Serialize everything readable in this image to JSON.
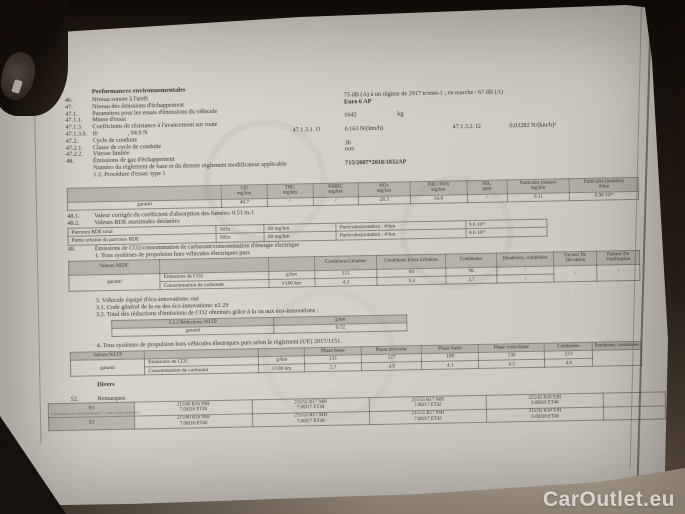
{
  "watermark": "CarOutlet.eu",
  "heading": "Performances environnementales",
  "bottom": {
    "divers": "Divers",
    "rem_num": "52.",
    "remarques": "Remarques",
    "tyres_note": "Combinaisons pneumatiques / roues homologuées :"
  },
  "top_lines": [
    {
      "n": "46.",
      "l": "Niveau sonore à l'arrêt",
      "v": "75 dB (A)    à un régime de 2917 tr/min-1 ; en marche :   67 dB (A)"
    },
    {
      "n": "47.",
      "l": "Niveau des émissions d'échappement",
      "v": "Euro 6 AP",
      "vb": true
    },
    {
      "n": "47.1.",
      "l": "Paramètres pour les essais d'émissions du véhicule"
    },
    {
      "n": "47.1.1.",
      "l": "Masse d'essai",
      "v": "1642",
      "v2": "kg"
    },
    {
      "n": "47.1.3.",
      "l": "Coefficients de résistance à l'avancement sur route"
    },
    {
      "n": "47.1.3.0.",
      "l": "f0",
      "ex": [
        {
          "t": ",  94.9 N",
          "x": 62
        },
        {
          "t": "47.1.3.1.  f1",
          "x": 227
        },
        {
          "t": "0.163 N/(km/h)",
          "x": 279
        },
        {
          "t": "47.1.3.2.  f2",
          "x": 387
        },
        {
          "t": "0.03282 N/(km/h)²",
          "x": 444
        }
      ]
    },
    {
      "n": "47.2.",
      "l": "Cycle de conduite"
    },
    {
      "n": "47.2.1.",
      "l": "Classe de cycle de conduite",
      "v": "3b"
    },
    {
      "n": "47.2.2.",
      "l": "Vitesse limitée",
      "v": "non"
    },
    {
      "n": "48.",
      "l": "Émissions de gaz d'échappement"
    },
    {
      "n": "",
      "l": "Numéro du règlement de base et du dernier règlement modificateur applicable",
      "v": "715/2007*2018/1832AP",
      "vb": true
    },
    {
      "n": "",
      "l": "1.2. Procédure d'essai: type 1"
    }
  ],
  "mid_lines": [
    {
      "n": "48.1.",
      "l": "Valeur corrigée du coefficient d'absorption des fumées: 0.51 m-1"
    },
    {
      "n": "48.2.",
      "l": "Valeurs RDE maximales déclarées"
    }
  ],
  "co2_lines": [
    {
      "n": "49.",
      "l": "Émissions de CO2/consommation de carburant/consommation d'énergie électrique"
    },
    {
      "n": "",
      "l": "1. Tous systèmes de propulsion hors véhicules électriques purs"
    }
  ],
  "eco_lines": [
    {
      "n": "",
      "l": "3. Véhicule équipé d'éco-innovations: oui"
    },
    {
      "n": "",
      "l": "3.1. Code général de la ou des éco-innovations: e2 29"
    },
    {
      "n": "",
      "l": "3.2. Total des réductions d'émissions de CO2 obtenues grâce à la ou aux éco-innovations :"
    }
  ],
  "wltp_lines": [
    {
      "n": "",
      "l": "4. Tous systèmes de propulsion hors véhicules électriques purs selon le règlement (UE) 2017/1151."
    }
  ],
  "tables": {
    "type1": {
      "left": 0,
      "top": 175,
      "width": 572,
      "colw": [
        27,
        8,
        8,
        8,
        9,
        10,
        7,
        11,
        12
      ],
      "header": [
        {
          "t": ""
        },
        {
          "t": "CO",
          "u": "mg/km"
        },
        {
          "t": "THC",
          "u": "mg/km"
        },
        {
          "t": "NMHC",
          "u": "mg/km"
        },
        {
          "t": "NOx",
          "u": "mg/km"
        },
        {
          "t": "THC+NOx",
          "u": "mg/km"
        },
        {
          "t": "NH₃",
          "u": "ppm"
        },
        {
          "t": "Particules (masse)",
          "u": "mg/km"
        },
        {
          "t": "Particules (nombre)",
          "u": "#/km"
        }
      ],
      "rows": [
        [
          "garanti",
          "46.7",
          "/",
          "/",
          "28.3",
          "34.8",
          "/",
          "0.11",
          "0.98 10¹¹"
        ]
      ]
    },
    "rde": {
      "left": 0,
      "top": 215,
      "width": 480,
      "colw": [
        31,
        10,
        15,
        27,
        17
      ],
      "rows": [
        [
          "Parcours RDE total",
          "NOx",
          "60 mg/km",
          "Particules(nombre) : #/km",
          "9.6 10¹¹"
        ],
        [
          "Partie urbaine du parcours RDE",
          "NOx",
          "60 mg/km",
          "Particules(nombre) : #/km",
          "6.6 10¹¹"
        ]
      ]
    },
    "nedc": {
      "left": 0,
      "top": 248,
      "width": 572,
      "colw": [
        16,
        19,
        8,
        11,
        12,
        9,
        10,
        7.5,
        7.5
      ],
      "header": [
        {
          "t": "Valeurs NEDC"
        },
        {
          "t": ""
        },
        {
          "t": ""
        },
        {
          "t": "Conditions Urbaines"
        },
        {
          "t": "Conditions Extra Urbaines"
        },
        {
          "t": "Combinées"
        },
        {
          "t": "Pondérées, combinées"
        },
        {
          "t": "Facteur De Déviation"
        },
        {
          "t": "Facteur De Vérification"
        }
      ],
      "rows": [
        [
          {
            "t": "garanti",
            "rs": 2
          },
          {
            "t": "Émissions de CO2",
            "cls": "lbl"
          },
          "g/km",
          "111",
          "90",
          "96",
          "/",
          {
            "t": "/",
            "rs": 2
          },
          {
            "t": "/",
            "rs": 2
          }
        ],
        [
          null,
          {
            "t": "Consommation de carburant",
            "cls": "lbl"
          },
          "l/100 km",
          "4.2",
          "3.4",
          "3.7",
          "/",
          null,
          null
        ]
      ]
    },
    "eco": {
      "left": 42,
      "top": 308,
      "width": 296,
      "colw": [
        55,
        45
      ],
      "header": [
        {
          "t": "3.2.2 Réductions WLTP"
        },
        {
          "t": "g/km"
        }
      ],
      "rows": [
        [
          "garanti",
          "0.72"
        ]
      ]
    },
    "wltp": {
      "left": 0,
      "top": 339,
      "width": 572,
      "colw": [
        13,
        20,
        8,
        10,
        10.5,
        10,
        11.5,
        8.5,
        8.5
      ],
      "header": [
        {
          "t": "Valeurs WLTP"
        },
        {
          "t": ""
        },
        {
          "t": ""
        },
        {
          "t": "Phase basse"
        },
        {
          "t": "Phase moyenne"
        },
        {
          "t": "Phase haute"
        },
        {
          "t": "Phase extra-haute"
        },
        {
          "t": "Combinées"
        },
        {
          "t": "Pondérées, combinées"
        }
      ],
      "rows": [
        [
          {
            "t": "garanti",
            "rs": 2
          },
          {
            "t": "Émissions de CO2",
            "cls": "lbl"
          },
          "g/km",
          "131",
          "127",
          "108",
          "130",
          "123",
          {
            "t": "",
            "rs": 2
          }
        ],
        [
          null,
          {
            "t": "Consommation de carburant",
            "cls": "lbl"
          },
          "l/100 km",
          "5.7",
          "4.9",
          "4.1",
          "4.5",
          "4.8",
          null
        ]
      ]
    },
    "tyres": {
      "left": -23,
      "top": 390,
      "width": 618,
      "colw": [
        14,
        19,
        19,
        19,
        19,
        10
      ],
      "rows": [
        [
          {
            "t": "E1",
            "cls": "shade"
          },
          {
            "lines": [
              "215/60 R16 99H",
              "7.00J16 ET40"
            ]
          },
          {
            "lines": [
              "215/55 R17 94H",
              "7.00J17 ET38"
            ]
          },
          {
            "lines": [
              "215/55 R17 94H",
              "7.00J17 ET42"
            ]
          },
          {
            "lines": [
              "215/45 R18 93H",
              "6.00J18 ET46"
            ]
          },
          ""
        ],
        [
          {
            "t": "E2",
            "cls": "shade"
          },
          {
            "lines": [
              "215/60 R16 99H",
              "7.00J16 ET40"
            ]
          },
          {
            "lines": [
              "215/55 R17 94H",
              "7.00J17 ET40"
            ]
          },
          {
            "lines": [
              "215/55 R17 94H",
              "7.00J17 ET42"
            ]
          },
          {
            "lines": [
              "215/45 R18 93H",
              "6.00J18 ET46"
            ]
          },
          ""
        ]
      ]
    }
  }
}
